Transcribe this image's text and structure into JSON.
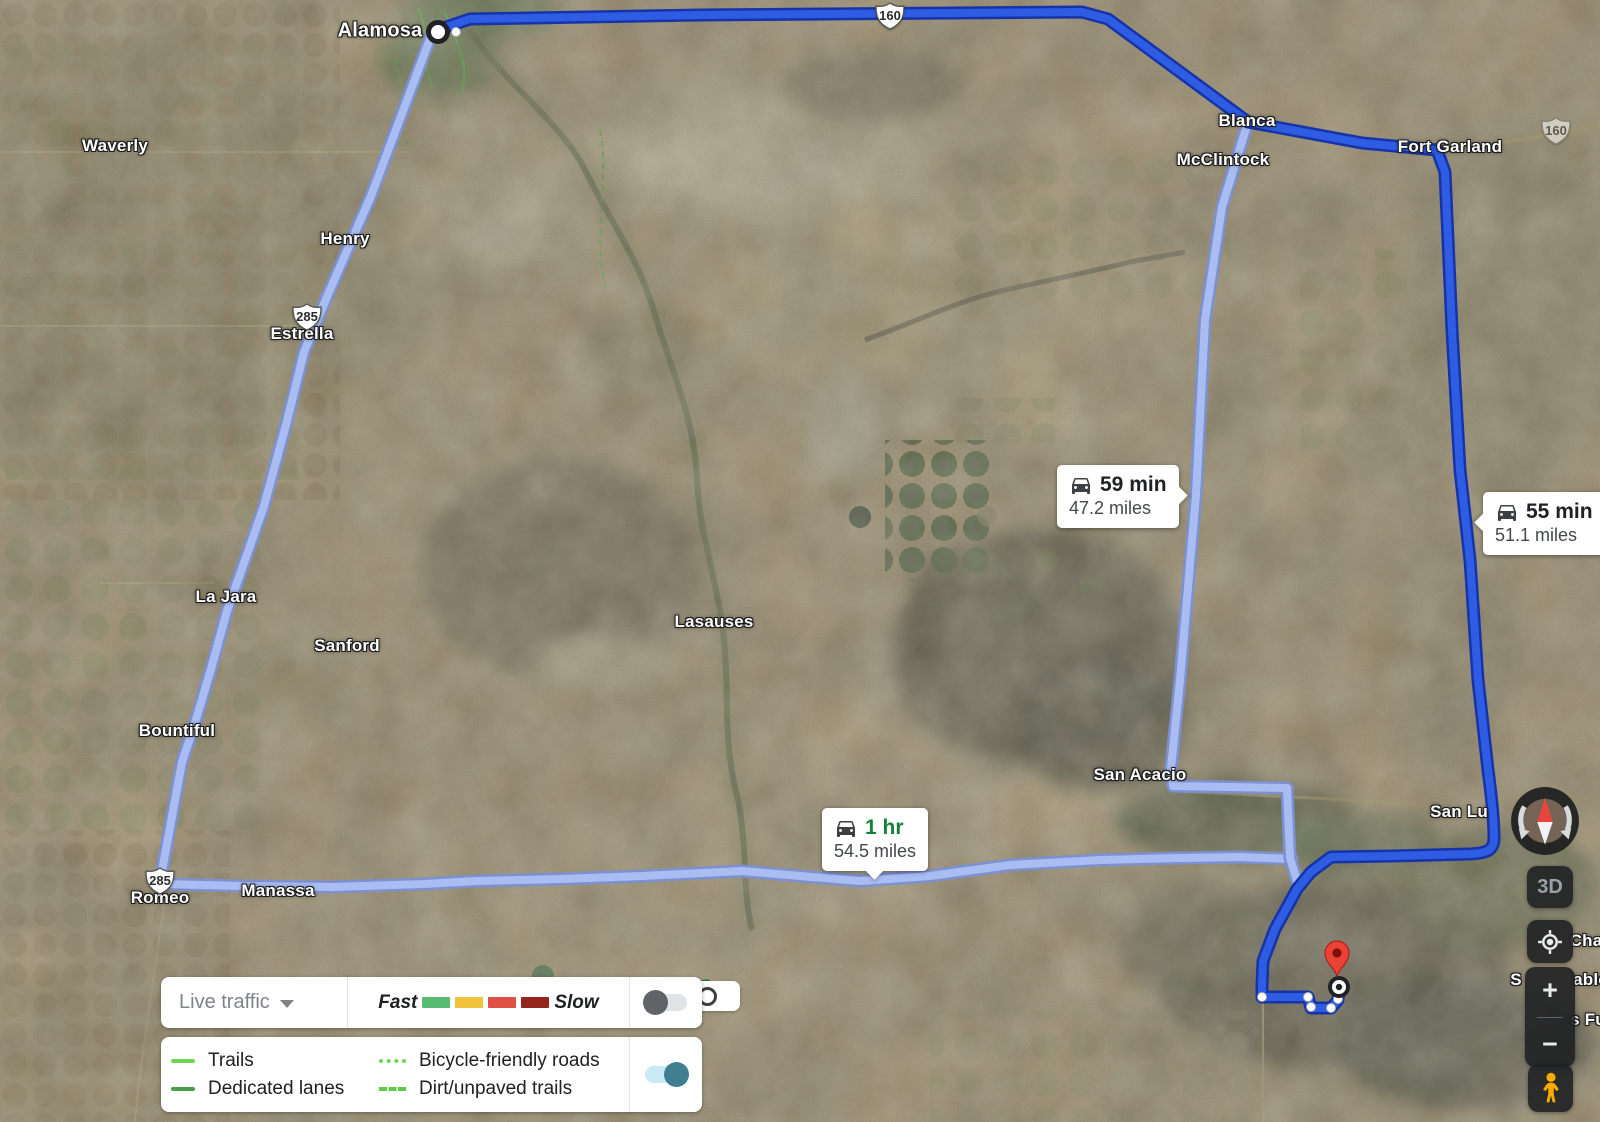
{
  "app": {
    "title": "Google Maps satellite route view"
  },
  "map": {
    "towns": [
      {
        "text": "Alamosa",
        "x": 380,
        "y": 31,
        "cls": "lg"
      },
      {
        "text": "Waverly",
        "x": 115,
        "y": 146,
        "cls": ""
      },
      {
        "text": "Henry",
        "x": 345,
        "y": 239,
        "cls": ""
      },
      {
        "text": "Estrella",
        "x": 302,
        "y": 334,
        "cls": ""
      },
      {
        "text": "La Jara",
        "x": 226,
        "y": 597,
        "cls": ""
      },
      {
        "text": "Sanford",
        "x": 347,
        "y": 646,
        "cls": ""
      },
      {
        "text": "Bountiful",
        "x": 177,
        "y": 731,
        "cls": ""
      },
      {
        "text": "Romeo",
        "x": 160,
        "y": 898,
        "cls": ""
      },
      {
        "text": "Manassa",
        "x": 278,
        "y": 891,
        "cls": ""
      },
      {
        "text": "Lasauses",
        "x": 714,
        "y": 622,
        "cls": ""
      },
      {
        "text": "Blanca",
        "x": 1247,
        "y": 121,
        "cls": ""
      },
      {
        "text": "McClintock",
        "x": 1223,
        "y": 160,
        "cls": ""
      },
      {
        "text": "Fort Garland",
        "x": 1450,
        "y": 147,
        "cls": ""
      },
      {
        "text": "San Acacio",
        "x": 1140,
        "y": 775,
        "cls": ""
      },
      {
        "text": "San Lu",
        "x": 1459,
        "y": 812,
        "cls": ""
      },
      {
        "text": "Cha",
        "x": 1586,
        "y": 941,
        "cls": ""
      },
      {
        "text": "S",
        "x": 1516,
        "y": 980,
        "cls": ""
      },
      {
        "text": "ablo",
        "x": 1591,
        "y": 980,
        "cls": ""
      },
      {
        "text": "s Fu",
        "x": 1588,
        "y": 1020,
        "cls": ""
      }
    ],
    "shields": [
      {
        "text": "160"
      },
      {
        "text": "160"
      },
      {
        "text": "285"
      },
      {
        "text": "285"
      }
    ],
    "badges": [
      {
        "time": "59 min",
        "distance": "47.2 miles",
        "time_color": "#202124"
      },
      {
        "time": "55 min",
        "distance": "51.1 miles",
        "time_color": "#202124"
      },
      {
        "time": "1 hr",
        "distance": "54.5 miles",
        "time_color": "#188038"
      }
    ],
    "route_colors": {
      "selected": "#2e5ce3",
      "selected_casing": "#1733a8",
      "alternate": "#aabdf2",
      "alternate_casing": "#7d90cf"
    }
  },
  "legend": {
    "traffic": {
      "label": "Live traffic",
      "fast_label": "Fast",
      "slow_label": "Slow",
      "colors": [
        "#58bb72",
        "#f0c33c",
        "#dd5144",
        "#94251c"
      ],
      "enabled": false
    },
    "bike": {
      "items": [
        {
          "label": "Trails",
          "color": "#6fd653"
        },
        {
          "label": "Bicycle-friendly roads",
          "color": "#6fd653"
        },
        {
          "label": "Dedicated lanes",
          "color": "#4a9e45"
        },
        {
          "label": "Dirt/unpaved trails",
          "color": "#5ecc41"
        }
      ],
      "enabled": true
    }
  },
  "controls": {
    "three_d": "3D",
    "zoom_in": "+",
    "zoom_out": "−"
  }
}
